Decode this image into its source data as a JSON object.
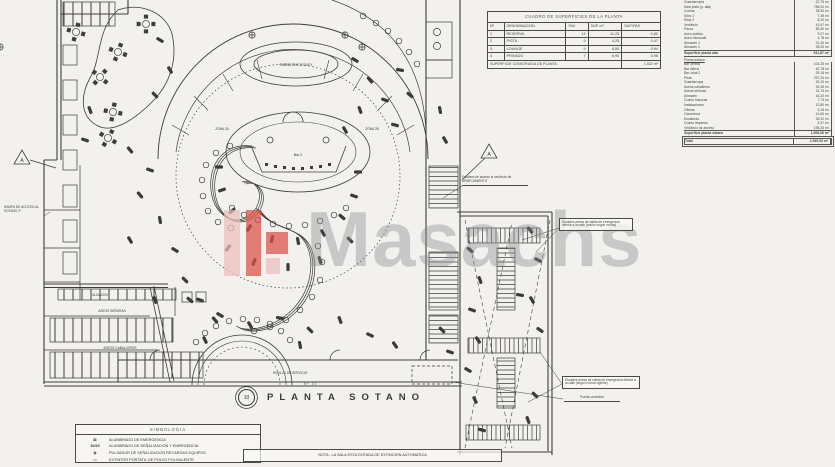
{
  "watermark": {
    "text": "Masachs",
    "logo_color": "#dd4f4a",
    "logo_color_light": "#eec0bd",
    "text_color": "#8f8e96"
  },
  "title_block": {
    "prefix": "Nº 10",
    "title": "PLANTA SOTANO",
    "marker": "10"
  },
  "note_box": {
    "text": "NOTA : LA SALA ESTA DOTADA DE EXTINCION AUTOMATICA"
  },
  "legend": {
    "header": "SIMBOLOGIA",
    "rows": [
      {
        "symbol": "⊠",
        "label": "ALUMBRADO DE EMERGENCIA"
      },
      {
        "symbol": "10/20",
        "label": "ALUMBRADO DE SEÑALIZACION Y EMERGENCIA"
      },
      {
        "symbol": "◉",
        "label": "PULSADOR DE SEÑALIZACION RECARGAS EQUIPOS"
      },
      {
        "symbol": "▭",
        "label": "EXTINTOR PORTATIL DE POLVO POLIVALENTE"
      }
    ]
  },
  "top_table": {
    "header": "CUADRO DE SUPERFICIES DE LA PLANTA",
    "columns": [
      "Nº",
      "DENOMINACION",
      "PAX",
      "SUP. m²",
      "SUP./PAX"
    ],
    "rows": [
      [
        "1",
        "RESERVA",
        "14",
        "11,25",
        "0,80"
      ],
      [
        "2",
        "PISTA",
        "9",
        "4,25",
        "0,47"
      ],
      [
        "3",
        "LOUNGE",
        "9",
        "8,50",
        "0,94"
      ],
      [
        "4",
        "PRIVADO",
        "7",
        "6,90",
        "0,98"
      ]
    ],
    "footer_label": "SUPERFICIE CONSTRUIDA DE PLANTA",
    "footer_value": "1.522 m²"
  },
  "area_table": {
    "rows1": [
      {
        "n": "Guardarropía",
        "v": "22,75 m²"
      },
      {
        "n": "Sala pista (p. alta)",
        "v": "756,00 m²"
      },
      {
        "n": "Cocina",
        "v": "28,50 m²"
      },
      {
        "n": "Silos 1",
        "v": "7,45 m²"
      },
      {
        "n": "Silos 2",
        "v": "8,20 m²"
      },
      {
        "n": "Vestíbulo",
        "v": "42,67 m²"
      },
      {
        "n": "Pasos",
        "v": "85,50 m²"
      },
      {
        "n": "Aseo público",
        "v": "9,07 m²"
      },
      {
        "n": "Aseo minusvál.",
        "v": "4,78 m²"
      },
      {
        "n": "Almacén 1",
        "v": "21,40 m²"
      },
      {
        "n": "Almacén 2",
        "v": "28,00 m²"
      }
    ],
    "subtotal1": {
      "n": "Superficie planta alta",
      "v": "941,87 m²"
    },
    "section2_heading": "Planta sótano",
    "rows2": [
      {
        "n": "Bar central",
        "v": "104,25 m²"
      },
      {
        "n": "Bar lateral",
        "v": "40,78 m²"
      },
      {
        "n": "Bar zona 2",
        "v": "29,18 m²"
      },
      {
        "n": "Pista",
        "v": "297,34 m²"
      },
      {
        "n": "Guardarropa",
        "v": "20,10 m²"
      },
      {
        "n": "Aseos caballeros",
        "v": "32,45 m²"
      },
      {
        "n": "Aseos señoras",
        "v": "31,76 m²"
      },
      {
        "n": "Almacén",
        "v": "16,22 m²"
      },
      {
        "n": "Cuarto basuras",
        "v": "7,74 m²"
      },
      {
        "n": "Instalaciones",
        "v": "12,80 m²"
      },
      {
        "n": "Oficina",
        "v": "9,15 m²"
      },
      {
        "n": "Camerinos",
        "v": "14,60 m²"
      },
      {
        "n": "Escaleras",
        "v": "35,92 m²"
      },
      {
        "n": "Cuarto limpieza",
        "v": "5,47 m²"
      },
      {
        "n": "Vestíbulo de acceso",
        "v": "195,30 m²"
      }
    ],
    "subtotal2": {
      "n": "Superficie planta sótano",
      "v": "1.008,06 m²"
    },
    "total": {
      "n": "Total",
      "v": "1.949,93 m²"
    }
  },
  "annotations": {
    "parking": "Escalera de acceso al vestíbulo de APARCAMIENTO",
    "emergency_top": "Escalera anexa de salida de emergencia directa a la calle (ancho según norma)",
    "emergency_bottom": "Escalera anexa de salida de emergencia directa a la calle (según norma vigente)",
    "ramp": "RAMPA DE ACCESO AL SOTANO 2º",
    "sliding_door": "Puerta corredera",
    "section_a": "A"
  },
  "plan_labels": {
    "cabina": "CABINA DISCJOCKEY",
    "stage_bar": "Bar 2",
    "zone_left": "ZONA 2A",
    "zone_right": "ZONA 2B",
    "corridor": "PASILLO DE SERVICIO",
    "aseos_s": "ASEOS SEÑORAS",
    "aseos_c": "ASEOS CABALLEROS",
    "almacen": "ALMACEN"
  }
}
